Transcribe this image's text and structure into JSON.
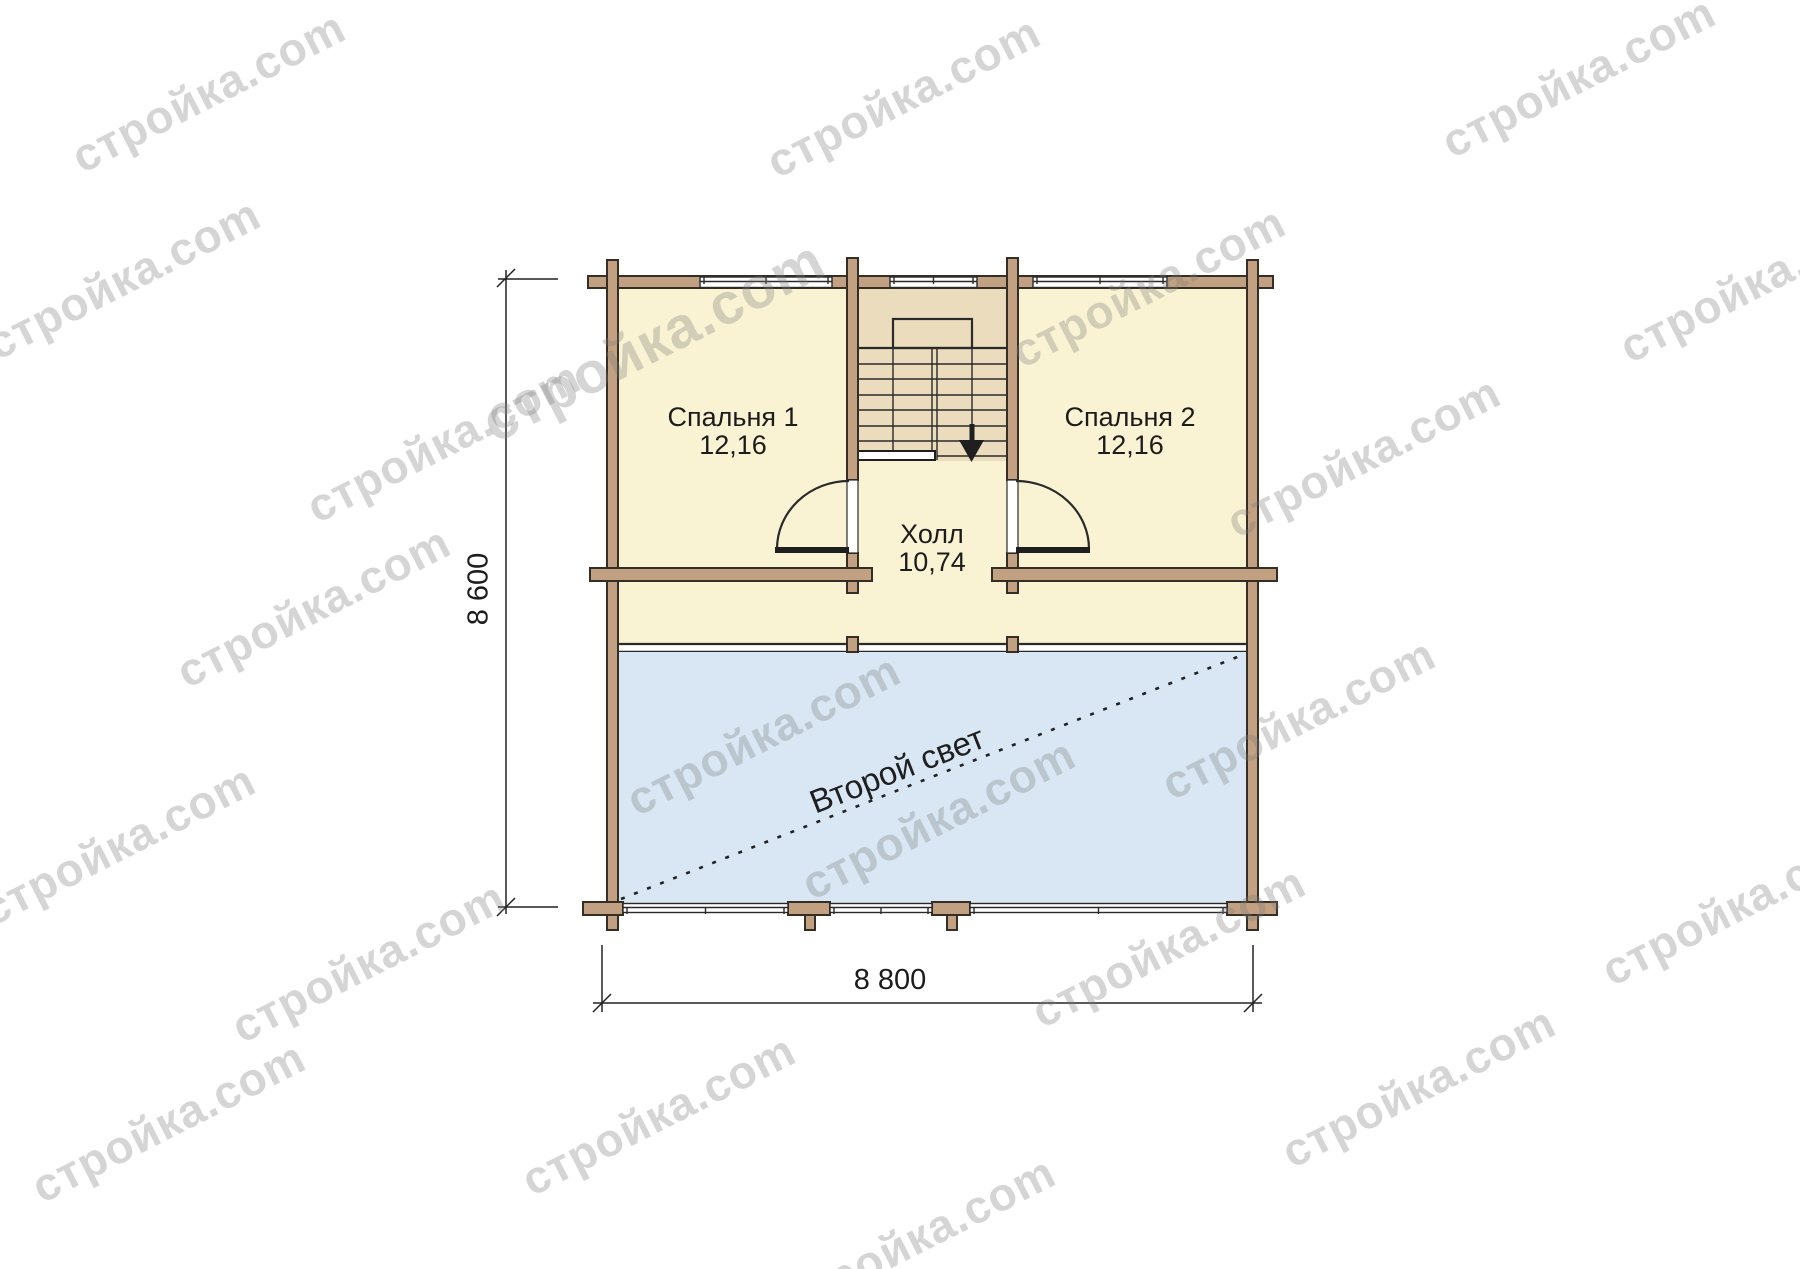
{
  "plan": {
    "rooms": {
      "bedroom1": {
        "name": "Спальня 1",
        "area": "12,16"
      },
      "bedroom2": {
        "name": "Спальня 2",
        "area": "12,16"
      },
      "hall": {
        "name": "Холл",
        "area": "10,74"
      },
      "second_light": {
        "name": "Второй свет"
      }
    },
    "dimensions": {
      "height": "8 600",
      "width": "8 800"
    },
    "colors": {
      "room_fill": "#faf3d3",
      "stair_fill": "#ebdcbd",
      "wall_fill": "#c1a181",
      "wall_stroke": "#352e24",
      "second_light_fill": "#d8e7f3",
      "line": "#2a2a2a",
      "label": "#1c1c1c",
      "watermark": "rgba(125,125,125,0.32)"
    }
  },
  "watermark": {
    "text": "стройка.com",
    "angle_deg": -27,
    "default_size": 46,
    "positions": [
      [
        210,
        95
      ],
      [
        905,
        100
      ],
      [
        1580,
        80
      ],
      [
        125,
        282
      ],
      [
        655,
        345,
        58
      ],
      [
        1150,
        290
      ],
      [
        1758,
        285
      ],
      [
        445,
        445
      ],
      [
        1365,
        460
      ],
      [
        315,
        610
      ],
      [
        765,
        738
      ],
      [
        1300,
        722
      ],
      [
        120,
        848
      ],
      [
        940,
        822
      ],
      [
        1740,
        908
      ],
      [
        370,
        965
      ],
      [
        1170,
        950
      ],
      [
        170,
        1125
      ],
      [
        660,
        1118
      ],
      [
        1420,
        1090
      ],
      [
        920,
        1240
      ]
    ]
  }
}
